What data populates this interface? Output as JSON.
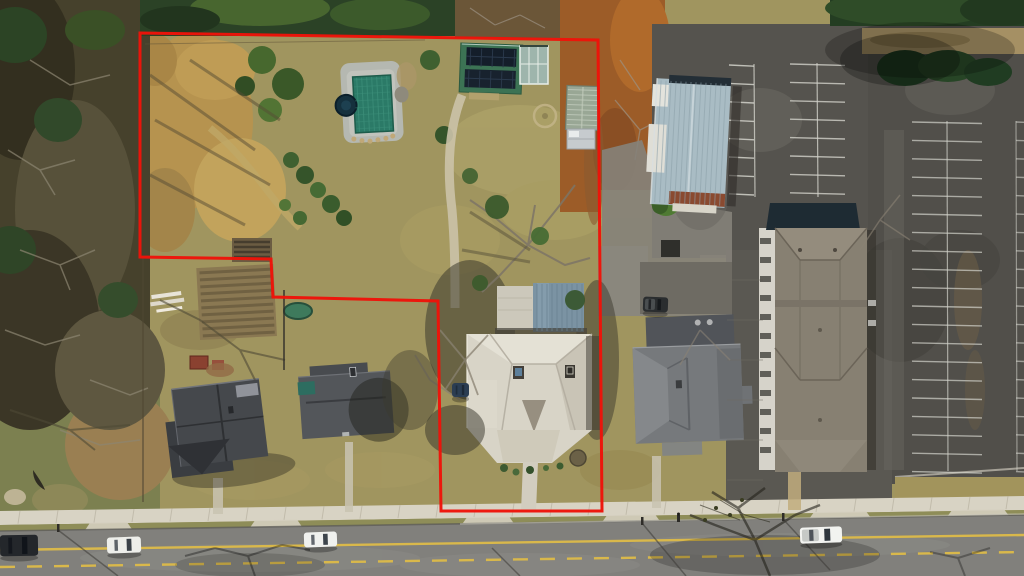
{
  "meta": {
    "kind": "aerial-drone-photo",
    "subject": "property parcel outlined in red, winter, top-down view",
    "canvas": {
      "w": 1024,
      "h": 576
    }
  },
  "palette": {
    "lawn": "#a0955f",
    "woods": "#46412c",
    "forest_top": "#2b4226",
    "dirt_gold": "#b6934f",
    "asphalt": "#55534e",
    "road": "#81807c",
    "sidewalk": "#d8d3c4",
    "stripe": "#d2d2ca",
    "yellow_line": "#d9b84b",
    "boundary_red": "#ee1309",
    "pool_cover": "#2b7a67",
    "pool_deck": "#b5b8b1",
    "solar_panel": "#141e2a",
    "green_roof": "#3c7354",
    "metal_roof_blue": "#7b93a3",
    "commercial_roof": "#a9bcc4",
    "house_roof_white": "#d8d4c7",
    "house_roof_dark": "#45484c",
    "house_roof_gray": "#76797c",
    "apartment_roof": "#878072",
    "greenhouse": "#99a795"
  },
  "boundary": {
    "color": "#ee1309",
    "stroke_width": 3,
    "points": [
      [
        140,
        33
      ],
      [
        598,
        40
      ],
      [
        602,
        511
      ],
      [
        441,
        511
      ],
      [
        438,
        301
      ],
      [
        273,
        297
      ],
      [
        271,
        259
      ],
      [
        140,
        257
      ]
    ]
  },
  "road": {
    "sidewalk_y_left": 511,
    "sidewalk_y_right": 496,
    "sidewalk_h": 14,
    "road_top_left": 531,
    "road_top_right": 515,
    "solid_line": {
      "x1": 0,
      "y1": 550,
      "x2": 1024,
      "y2": 535,
      "w": 2.4,
      "color": "#d9b84b"
    },
    "dashed_line": {
      "x1": 0,
      "y1": 567,
      "x2": 1024,
      "y2": 552,
      "w": 2.4,
      "dash": "15 12",
      "color": "#d9b84b"
    },
    "aprons": [
      [
        84,
        133
      ],
      [
        249,
        303
      ],
      [
        461,
        515
      ],
      [
        601,
        661
      ],
      [
        808,
        872
      ],
      [
        946,
        1010
      ]
    ],
    "apron_color": "#d5cfc0"
  },
  "parking": {
    "stripe_color": "#d2d2ca",
    "columns": [
      {
        "name": "west-row",
        "x1": 729,
        "x2": 754,
        "y0": 65,
        "dy": 18.4,
        "n": 8,
        "slope": 1.2,
        "o": 0.85
      },
      {
        "name": "mid-double-row",
        "x1": 790,
        "x2": 845,
        "y0": 64,
        "dy": 18.4,
        "n": 8,
        "slope": 1.4,
        "o": 0.8
      },
      {
        "name": "east-double-row",
        "x1": 912,
        "x2": 982,
        "y0": 122,
        "dy": 18.4,
        "n": 20,
        "slope": 1.5,
        "o": 0.7
      },
      {
        "name": "edge-row",
        "x1": 1016,
        "x2": 1024,
        "y0": 122,
        "dy": 18.4,
        "n": 20,
        "slope": 0.3,
        "o": 0.6
      }
    ],
    "verticals": [
      {
        "x": 754,
        "y1": 64,
        "y2": 197,
        "o": 0.8
      },
      {
        "x": 817,
        "y1": 63,
        "y2": 197,
        "o": 0.8
      },
      {
        "x": 947,
        "y1": 121,
        "y2": 471,
        "o": 0.7
      },
      {
        "x": 1016,
        "y1": 121,
        "y2": 471,
        "o": 0.55
      }
    ]
  },
  "vehicles": [
    {
      "name": "parked-car-dark",
      "x": 0,
      "y": 535,
      "w": 38,
      "h": 21,
      "angle": -1,
      "body": "#24272b",
      "glass": "#10141a",
      "bed": null
    },
    {
      "name": "car-white-west",
      "x": 107,
      "y": 537,
      "w": 34,
      "h": 16,
      "angle": -2,
      "body": "#edeeea",
      "glass": "#3a4148",
      "bed": null
    },
    {
      "name": "car-white-east",
      "x": 304,
      "y": 532,
      "w": 33,
      "h": 15,
      "angle": -2,
      "body": "#f0f1ee",
      "glass": "#3e454c",
      "bed": null
    },
    {
      "name": "pickup-white",
      "x": 800,
      "y": 527,
      "w": 42,
      "h": 16,
      "angle": -2,
      "body": "#f2f3f0",
      "glass": "#2f363d",
      "bed": "#c6c9c6"
    },
    {
      "name": "pickup-dark-driveway",
      "x": 643,
      "y": 297,
      "w": 25,
      "h": 15,
      "angle": 2,
      "body": "#2a2d2f",
      "glass": "#16191c",
      "bed": "#4a4e50"
    },
    {
      "name": "car-blue-backyard",
      "x": 452,
      "y": 383,
      "w": 17,
      "h": 14,
      "angle": 0,
      "body": "#2b3d52",
      "glass": "#1c2836",
      "bed": null
    }
  ],
  "textures": [
    {
      "name": "commercial-roof-ribs",
      "type": "vlines",
      "x1": 658,
      "x2": 726,
      "step": 5,
      "y1": 82,
      "y2": 204,
      "color": "#8ea2ab",
      "w": 1,
      "o": 0.6,
      "tr": "rotate(3 690 140)"
    },
    {
      "name": "metal-roof-seams",
      "type": "vlines",
      "x1": 537,
      "x2": 582,
      "step": 5,
      "y1": 284,
      "y2": 331,
      "color": "#69818f",
      "w": 1,
      "o": 0.7,
      "tr": ""
    },
    {
      "name": "greenhouse-hoops",
      "type": "hlines",
      "x1": 567,
      "x2": 597,
      "step": 5,
      "y1": 90,
      "y2": 127,
      "color": "#c2ccbd",
      "w": 1,
      "o": 0.8,
      "tr": "rotate(2 582 116)"
    },
    {
      "name": "pool-cover-grid-v",
      "type": "vlines",
      "x1": 358,
      "x2": 390,
      "step": 5,
      "y1": 77,
      "y2": 131,
      "color": "#3c8e79",
      "w": 1,
      "o": 0.8,
      "tr": "rotate(-3 372 103)"
    },
    {
      "name": "pool-cover-grid-h",
      "type": "hlines",
      "x1": 355,
      "x2": 391,
      "step": 7,
      "y1": 79,
      "y2": 130,
      "color": "#3c8e79",
      "w": 1,
      "o": 0.5,
      "tr": "rotate(-3 372 103)"
    },
    {
      "name": "solar-array-1-grid",
      "type": "vlines",
      "x1": 470,
      "x2": 514,
      "step": 11,
      "y1": 49,
      "y2": 67,
      "color": "#2b3a4d",
      "w": 1,
      "o": 0.9,
      "tr": "rotate(2 490 68)"
    },
    {
      "name": "solar-array-2-grid",
      "type": "vlines",
      "x1": 469,
      "x2": 513,
      "step": 11,
      "y1": 71,
      "y2": 88,
      "color": "#2b3a4d",
      "w": 1,
      "o": 0.9,
      "tr": "rotate(2 490 68)"
    },
    {
      "name": "garden-bed-rows",
      "type": "hlines",
      "x1": 234,
      "x2": 270,
      "step": 5,
      "y1": 242,
      "y2": 259,
      "color": "#3e362a",
      "w": 2.5,
      "o": 0.8,
      "tr": ""
    },
    {
      "name": "terrace-garden-rows",
      "type": "hlines",
      "x1": 201,
      "x2": 273,
      "step": 7,
      "y1": 271,
      "y2": 334,
      "color": "#66583c",
      "w": 3,
      "o": 0.7,
      "tr": "rotate(-3 237 300)"
    },
    {
      "name": "corridor-joints",
      "type": "hlines",
      "x1": 727,
      "x2": 763,
      "step": 40,
      "y1": 280,
      "y2": 500,
      "color": "#6f6c64",
      "w": 1,
      "o": 0.5,
      "tr": ""
    },
    {
      "name": "apartment-windows",
      "type": "windows",
      "x": 760,
      "y0": 238,
      "dy": 19,
      "n": 12,
      "w": 11,
      "h": 6,
      "color": "#53524c",
      "o": 0.9
    },
    {
      "name": "sidewalk-joints",
      "type": "joints",
      "x0": 20,
      "step": 38,
      "yl": 511,
      "yr": 496,
      "h": 13,
      "color": "#b3ac9b",
      "w": 1,
      "o": 0.6
    }
  ],
  "structures": [
    {
      "name": "pool-with-green-cover",
      "color": "#2b7a67"
    },
    {
      "name": "hot-tub",
      "color": "#15303d"
    },
    {
      "name": "solar-panel-building",
      "color": "#3c7354"
    },
    {
      "name": "sunroom",
      "color": "#9eb5ac"
    },
    {
      "name": "greenhouse",
      "color": "#99a795"
    },
    {
      "name": "silver-shed",
      "color": "#c6cbce"
    },
    {
      "name": "main-house-white-roof",
      "color": "#d8d4c7"
    },
    {
      "name": "commercial-metal-building",
      "color": "#a9bcc4"
    },
    {
      "name": "house-dark-roof-west",
      "color": "#45484c"
    },
    {
      "name": "house-gray-roof-mid",
      "color": "#53565a"
    },
    {
      "name": "house-gray-roof-east",
      "color": "#76797c"
    },
    {
      "name": "apartment-building",
      "color": "#878072"
    },
    {
      "name": "trampoline",
      "color": "#3e7a5c"
    },
    {
      "name": "parking-lot",
      "color": "#55534e"
    }
  ]
}
